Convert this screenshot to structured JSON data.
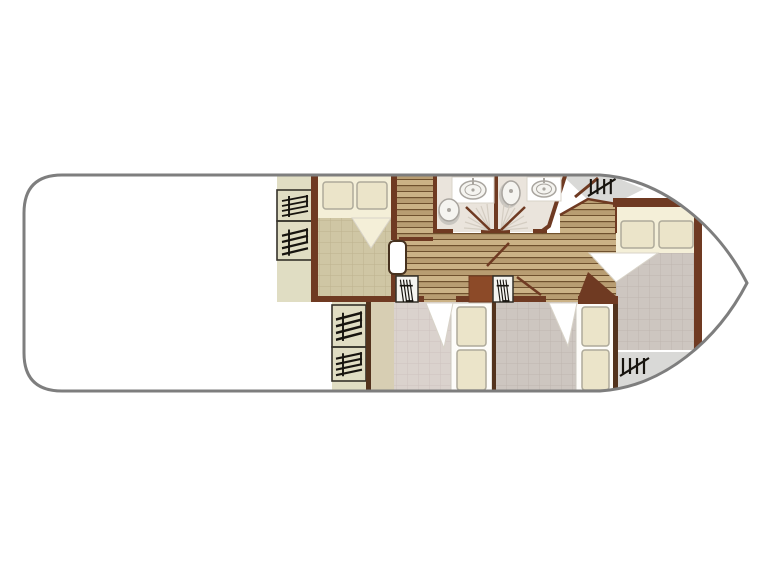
{
  "plan": {
    "type": "boat-floor-plan",
    "rooms": [
      {
        "id": "aft-deck",
        "feature": "open-deck"
      },
      {
        "id": "aft-cabin",
        "feature": "double-bed"
      },
      {
        "id": "wardrobe-column-aft",
        "feature": "wardrobes"
      },
      {
        "id": "bathroom-left",
        "features": [
          "sink",
          "toilet",
          "door-swing"
        ]
      },
      {
        "id": "bathroom-right",
        "features": [
          "toilet",
          "sink",
          "door-swing"
        ]
      },
      {
        "id": "corridor",
        "feature": "wood-floor"
      },
      {
        "id": "mid-cabin-left",
        "feature": "single-beds"
      },
      {
        "id": "mid-cabin-right",
        "feature": "single-beds"
      },
      {
        "id": "bow-cabin",
        "feature": "double-bed"
      },
      {
        "id": "bow-deck",
        "feature": "steps"
      }
    ]
  },
  "colors": {
    "background": "#ffffff",
    "hull_outline": "#7e7e7e",
    "hull_fill": "#ffffff",
    "wall": "#6f3a22",
    "wall_accent": "#8c4a28",
    "wall_thin": "#53331d",
    "wood_light": "#cbb286",
    "wood_mid": "#b89d72",
    "wood_line": "#6f512e",
    "aft_blanket": "#cfc6a4",
    "aft_blanket_grid": "#bdb28e",
    "cabin_tile": "#dad2cd",
    "cabin_tile_grid": "#cdc3be",
    "bow_tile": "#cdc6c0",
    "bow_tile_grid": "#beb6af",
    "deck": "#d9d9d7",
    "bathroom_floor": "#eae4dc",
    "bed_sheet": "#f4efd8",
    "pillow": "#ebe4c9",
    "pillow_border": "#aeaa9a",
    "mattress": "#fdfcf9",
    "mattress_border": "#ccc8bf",
    "fold": "#ffffff",
    "fold_border": "#d8d3c8",
    "wardrobe_fill": "#e0ddc3",
    "wardrobe_border": "#35322a",
    "hatch": "#17140f",
    "shelf": "#d7ceb3",
    "fixture_fill": "#f5f4f0",
    "fixture_stroke": "#a9a59f",
    "fixture_shadow": "#c9c6c0",
    "swing_ray": "#d4cdc2",
    "door_white_border": "#46311e"
  }
}
